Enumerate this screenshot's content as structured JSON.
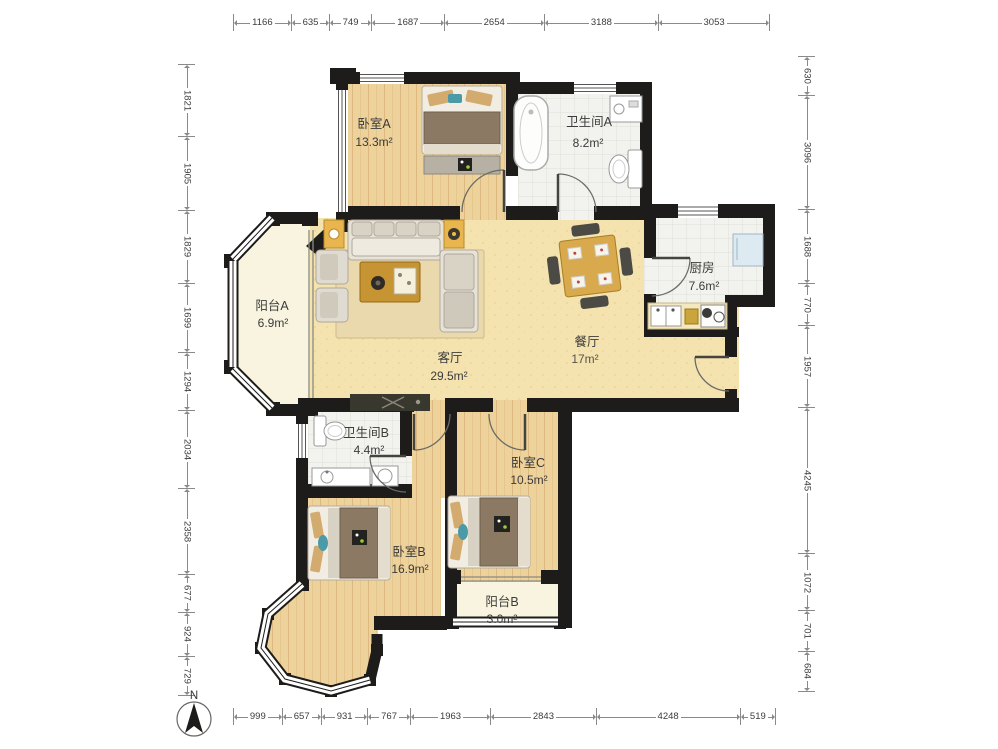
{
  "plan": {
    "compass_label": "N",
    "rooms": {
      "bedroom_a": {
        "name": "卧室A",
        "area": "13.3m²"
      },
      "bathroom_a": {
        "name": "卫生间A",
        "area": "8.2m²"
      },
      "kitchen": {
        "name": "厨房",
        "area": "7.6m²"
      },
      "balcony_a": {
        "name": "阳台A",
        "area": "6.9m²"
      },
      "living_room": {
        "name": "客厅",
        "area": "29.5m²"
      },
      "dining_room": {
        "name": "餐厅",
        "area": "17m²"
      },
      "bathroom_b": {
        "name": "卫生间B",
        "area": "4.4m²"
      },
      "bedroom_c": {
        "name": "卧室C",
        "area": "10.5m²"
      },
      "bedroom_b": {
        "name": "卧室B",
        "area": "16.9m²"
      },
      "balcony_b": {
        "name": "阳台B",
        "area": "3.0m²"
      }
    },
    "dimensions_mm": {
      "top": [
        1166,
        635,
        749,
        1687,
        2654,
        3188,
        3053
      ],
      "bottom": [
        999,
        657,
        931,
        767,
        1963,
        2843,
        4248,
        519
      ],
      "left": [
        1821,
        1905,
        1829,
        1699,
        1294,
        2034,
        2358,
        677,
        924,
        729
      ],
      "right": [
        630,
        3096,
        1688,
        770,
        1957,
        4245,
        1072,
        701,
        684
      ]
    },
    "colors": {
      "wall": "#1d1c1a",
      "wood_floor": "#edd29b",
      "main_floor": "#f4e2af",
      "tile_floor": "#f2f2ee",
      "balcony_floor": "#f8f4df"
    }
  }
}
